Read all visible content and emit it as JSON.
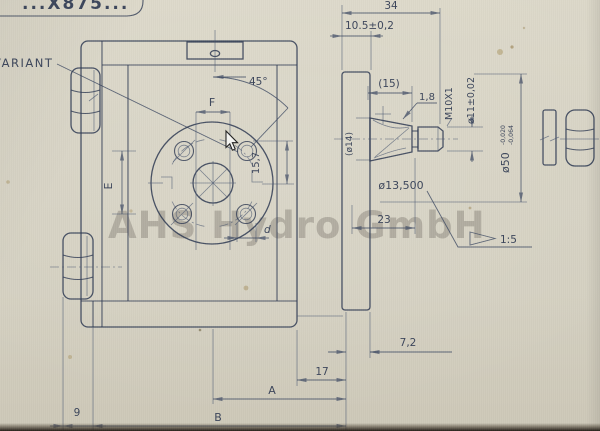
{
  "drawing": {
    "part_number": "...X875...",
    "variant_label": "VARIANT",
    "watermark": "AHS Hydro GmbH",
    "dims": {
      "overall_width": "34",
      "flange_thickness": "10.5±0,2",
      "taper_length": "(15)",
      "key_height": "1,8",
      "thread": "M10X1",
      "dia_11": "ø11±0,02",
      "dia_50": "ø50",
      "dia_50_tol_upper": "-0,020",
      "dia_50_tol_lower": "-0,064",
      "dia_14": "(ø14)",
      "dia_taper_gauge": "ø13,500",
      "taper_ref_length": "23",
      "taper_ratio": "1:5",
      "step_7_2": "7,2",
      "offset_17": "17",
      "dim_A": "A",
      "dim_B": "B",
      "offset_9": "9",
      "dim_E": "E",
      "dim_F": "F",
      "dim_d": "d",
      "hole_offset_15_7": "15,7",
      "angle_45": "45°"
    },
    "colors": {
      "line": "#2e3a52",
      "paper": "#d6d2c3",
      "watermark_gray": "#6a655c"
    }
  }
}
